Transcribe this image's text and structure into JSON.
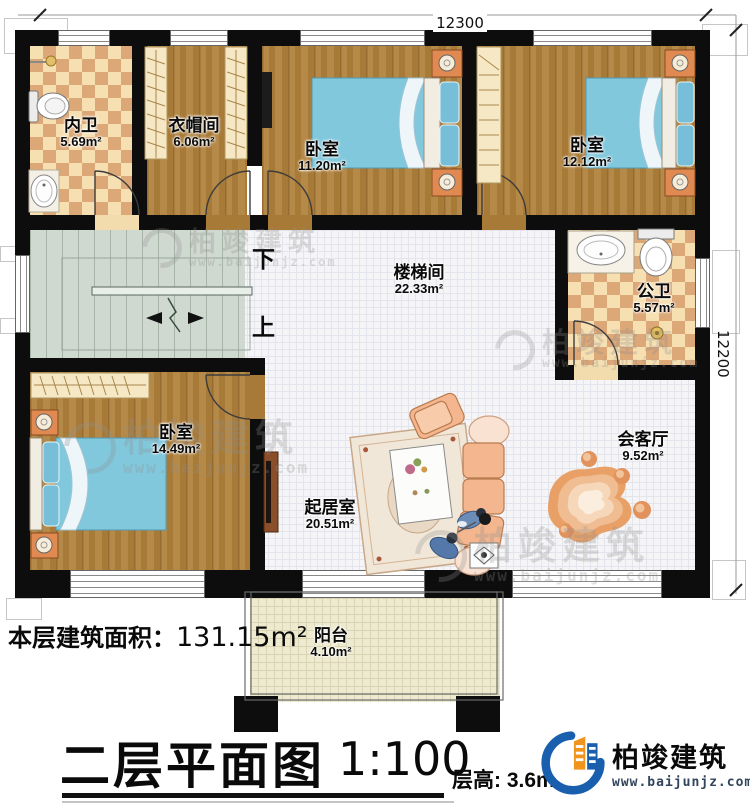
{
  "plan": {
    "title": "二层平面图",
    "scale": "1:100",
    "floor_height": "层高: 3.6m",
    "floor_area_label": "本层建筑面积：",
    "floor_area_value": "131.15m²"
  },
  "dimensions": {
    "top": "12300",
    "right": "12200"
  },
  "stairs": {
    "down": "下",
    "up": "上"
  },
  "rooms": [
    {
      "name": "内卫",
      "area": "5.69m²"
    },
    {
      "name": "衣帽间",
      "area": "6.06m²"
    },
    {
      "name": "卧室",
      "area": "11.20m²"
    },
    {
      "name": "卧室",
      "area": "12.12m²"
    },
    {
      "name": "楼梯间",
      "area": "22.33m²"
    },
    {
      "name": "公卫",
      "area": "5.57m²"
    },
    {
      "name": "卧室",
      "area": "14.49m²"
    },
    {
      "name": "起居室",
      "area": "20.51m²"
    },
    {
      "name": "会客厅",
      "area": "9.52m²"
    },
    {
      "name": "阳台",
      "area": "4.10m²"
    }
  ],
  "brand": {
    "name": "柏竣建筑",
    "url": "www.baijunjz.com"
  },
  "watermark": {
    "name": "柏竣建筑",
    "url": "www.baijunjz.com"
  },
  "colors": {
    "wall": "#0d0d0d",
    "wood": "#a87a38",
    "tile": "#f5f5f7",
    "stair_floor": "#cfd9d0",
    "checker_dark": "#dca878",
    "checker_light": "#f6e0b2",
    "balcony": "#edeacf",
    "bed_blue": "#82c8dd",
    "sofa_peach": "#f3b68e",
    "rug_orange": "#e8a066",
    "brand_blue": "#1a5fae",
    "brand_orange": "#f0941e"
  }
}
